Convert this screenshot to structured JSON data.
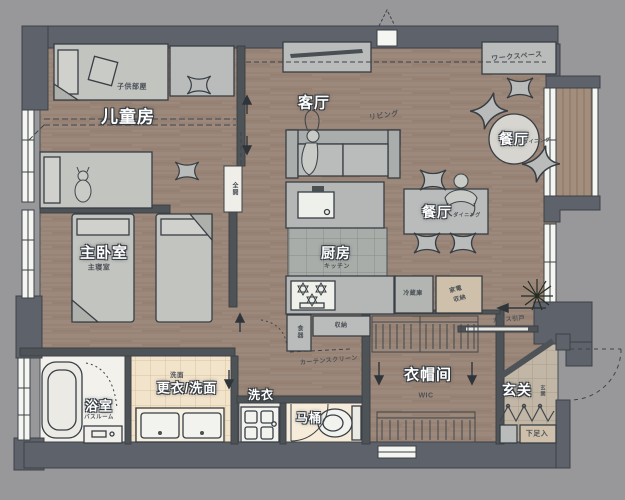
{
  "rooms": {
    "children_room": {
      "label": "儿童房",
      "sub": "子供部屋"
    },
    "master_bedroom": {
      "label": "主卧室",
      "sub": "主寝室"
    },
    "living_room": {
      "label": "客厅",
      "sub": "リビング"
    },
    "dining_main": {
      "label": "餐厅",
      "sub": "ダイニング"
    },
    "dining_round": {
      "label": "餐厅",
      "sub": "ダイニング"
    },
    "workspace": {
      "label": "ワークスペース"
    },
    "kitchen": {
      "label": "厨房",
      "sub": "キッチン"
    },
    "bathroom": {
      "label": "浴室",
      "sub": "バスルーム"
    },
    "dressing_washroom": {
      "label": "更衣/洗面",
      "sub": "洗面"
    },
    "laundry": {
      "label": "洗衣"
    },
    "toilet": {
      "label": "马桶"
    },
    "walk_in_closet": {
      "label": "衣帽间",
      "sub": "WIC"
    },
    "entrance": {
      "label": "玄关",
      "sub": "玄関"
    }
  },
  "annotations": {
    "refrigerator": "冷蔵庫",
    "appliance_storage_line1": "家電",
    "appliance_storage_line2": "収納",
    "storage": "収納",
    "dish_cabinet": "食器",
    "curtain_screen": "カーテンスクリーン",
    "glass_sliding_door": "ガラス引戸",
    "shoe_cabinet": "下足入",
    "sliding_panel": "全開"
  },
  "colors": {
    "background": "#98989b",
    "wall": "#5e626a",
    "wood_floor": "#9d897b",
    "furniture": "#b9bcba",
    "cream_tile": "#f2e3cb",
    "bath_white": "#f2f1ec",
    "label_halo": "#353b41"
  }
}
